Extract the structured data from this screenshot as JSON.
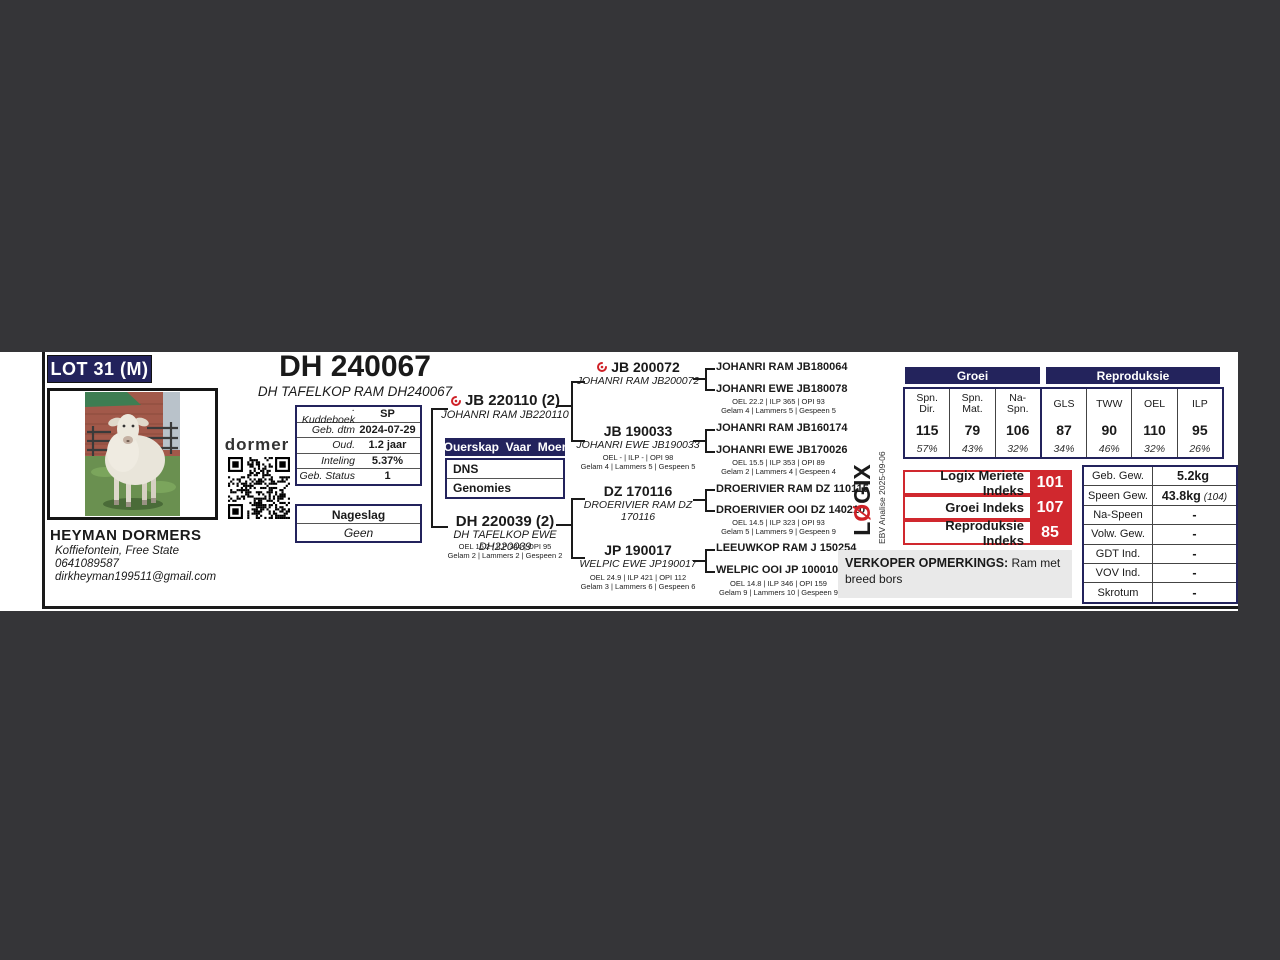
{
  "lot_badge": "LOT 31 (M)",
  "animal": {
    "title": "DH 240067",
    "subtitle": "DH TAFELKOP RAM DH240067"
  },
  "breeder": {
    "name": "HEYMAN DORMERS",
    "location": "Koffiefontein, Free State",
    "phone": "0641089587",
    "email": "dirkheyman199511@gmail.com"
  },
  "brand_logo": "dormer",
  "info_table": {
    "rows": [
      {
        "label": ". Kuddeboek",
        "value": "SP"
      },
      {
        "label": "Geb. dtm",
        "value": "2024-07-29"
      },
      {
        "label": "Oud.",
        "value": "1.2 jaar"
      },
      {
        "label": "Inteling",
        "value": "5.37%"
      },
      {
        "label": "Geb. Status",
        "value": "1"
      }
    ]
  },
  "nageslag": {
    "header": "Nageslag",
    "value": "Geen"
  },
  "ouerskap": {
    "header": "Ouerskap  Vaar  Moer",
    "row1": "DNS",
    "row2": "Genomies"
  },
  "pedigree": {
    "sire": {
      "id": "JB 220110 (2)",
      "name": "JOHANRI RAM JB220110"
    },
    "dam": {
      "id": "DH 220039 (2)",
      "name": "DH TAFELKOP EWE DH220039",
      "stats1": "OEL 16.2 | ILP 344 | OPI 95",
      "stats2": "Gelam 2 | Lammers 2 | Gespeen 2"
    },
    "grandparents": [
      {
        "id": "JB 200072",
        "name": "JOHANRI RAM JB200072"
      },
      {
        "id": "JB 190033",
        "name": "JOHANRI EWE JB190033",
        "stats1": "OEL - | ILP - | OPI 98",
        "stats2": "Gelam 4 | Lammers 5 | Gespeen 5"
      },
      {
        "id": "DZ 170116",
        "name": "DROERIVIER RAM DZ 170116"
      },
      {
        "id": "JP 190017",
        "name": "WELPIC EWE JP190017",
        "stats1": "OEL 24.9 | ILP 421 | OPI 112",
        "stats2": "Gelam 3 | Lammers 6 | Gespeen 6"
      }
    ],
    "greatgrandparents": [
      {
        "name": "JOHANRI RAM JB180064"
      },
      {
        "name": "JOHANRI EWE JB180078",
        "stats1": "OEL 22.2 | ILP 365 | OPI 93",
        "stats2": "Gelam 4 | Lammers 5 | Gespeen 5"
      },
      {
        "name": "JOHANRI RAM JB160174"
      },
      {
        "name": "JOHANRI EWE JB170026",
        "stats1": "OEL 15.5 | ILP 353 | OPI 89",
        "stats2": "Gelam 2 | Lammers 4 | Gespeen 4"
      },
      {
        "name": "DROERIVIER RAM DZ 110115"
      },
      {
        "name": "DROERIVIER OOI DZ 140210",
        "stats1": "OEL 14.5 | ILP 323 | OPI 93",
        "stats2": "Gelam 5 | Lammers 9 | Gespeen 9"
      },
      {
        "name": "LEEUWKOP RAM J 150254"
      },
      {
        "name": "WELPIC OOI JP 100010",
        "stats1": "OEL 14.8 | ILP 346 | OPI 159",
        "stats2": "Gelam 9 | Lammers 10 | Gespeen 9"
      }
    ]
  },
  "ebv": {
    "groei_header": "Groei",
    "repro_header": "Reproduksie",
    "cols": [
      {
        "h1": "Spn.",
        "h2": "Dir.",
        "value": "115",
        "pct": "57%"
      },
      {
        "h1": "Spn.",
        "h2": "Mat.",
        "value": "79",
        "pct": "43%"
      },
      {
        "h1": "Na-",
        "h2": "Spn.",
        "value": "106",
        "pct": "32%"
      },
      {
        "h1": "GLS",
        "h2": "",
        "value": "87",
        "pct": "34%"
      },
      {
        "h1": "TWW",
        "h2": "",
        "value": "90",
        "pct": "46%"
      },
      {
        "h1": "OEL",
        "h2": "",
        "value": "110",
        "pct": "32%"
      },
      {
        "h1": "ILP",
        "h2": "",
        "value": "95",
        "pct": "26%"
      }
    ]
  },
  "indices": [
    {
      "label": "Logix Meriete Indeks",
      "value": "101"
    },
    {
      "label": "Groei Indeks",
      "value": "107"
    },
    {
      "label": "Reproduksie Indeks",
      "value": "85"
    }
  ],
  "logix": {
    "l1": "L",
    "l2": "Ø",
    "l3": "GIX",
    "analysis": "EBV Analise 2025-09-06"
  },
  "verkoper": {
    "label": "VERKOPER OPMERKINGS:",
    "text": " Ram met breed bors"
  },
  "stats_table": {
    "rows": [
      {
        "label": "Geb. Gew.",
        "value": "5.2kg",
        "note": ""
      },
      {
        "label": "Speen Gew.",
        "value": "43.8kg",
        "note": "(104)"
      },
      {
        "label": "Na-Speen",
        "value": "-",
        "note": ""
      },
      {
        "label": "Volw. Gew.",
        "value": "-",
        "note": ""
      },
      {
        "label": "GDT Ind.",
        "value": "-",
        "note": ""
      },
      {
        "label": "VOV Ind.",
        "value": "-",
        "note": ""
      },
      {
        "label": "Skrotum",
        "value": "-",
        "note": ""
      }
    ]
  },
  "colors": {
    "navy": "#23235c",
    "red": "#d0282e",
    "viewer_bg": "#353538",
    "page_bg": "#ffffff"
  }
}
